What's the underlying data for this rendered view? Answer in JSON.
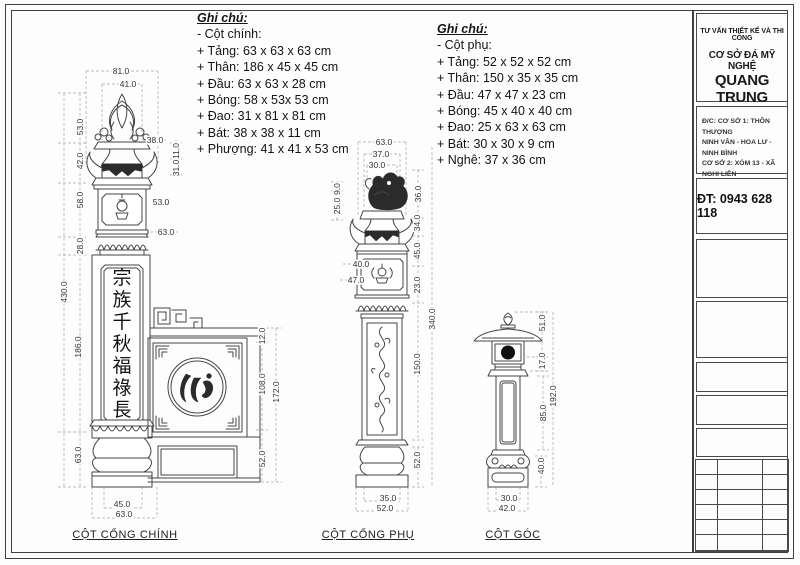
{
  "colors": {
    "line": "#454545",
    "dim_text": "#333333",
    "dashed": "#a6a6a6",
    "dark_fill": "#2b2b2b",
    "frame": "#3f3f3f"
  },
  "notes": {
    "main": {
      "title": "Ghi chú:",
      "subtitle": "- Cột chính:",
      "items": [
        "+ Tảng: 63 x 63 x 63 cm",
        "+ Thân: 186 x 45 x 45 cm",
        "+ Đầu: 63 x 63 x 28 cm",
        "+ Bóng: 58 x 53x 53 cm",
        "+ Đao: 31 x 81 x 81 cm",
        "+ Bát: 38 x 38 x 11 cm",
        "+ Phượng: 41 x 41 x 53 cm"
      ]
    },
    "secondary": {
      "title": "Ghi chú:",
      "subtitle": "- Cột phụ:",
      "items": [
        "+ Tảng: 52 x 52 x 52 cm",
        "+ Thân: 150 x 35 x 35 cm",
        "+ Đầu: 47 x 47 x 23 cm",
        "+ Bóng: 45 x 40 x 40 cm",
        "+ Đao: 25 x 63 x 63 cm",
        "+ Bát: 30 x 30 x 9 cm",
        "+ Nghê: 37 x 36  cm"
      ]
    }
  },
  "captions": {
    "main": "CỘT CỔNG CHÍNH",
    "secondary": "CỘT CỔNG PHỤ",
    "corner": "CỘT GÓC"
  },
  "inscription": {
    "characters": [
      "宗",
      "族",
      "千",
      "秋",
      "福",
      "祿",
      "長"
    ],
    "emblem_character": "心"
  },
  "title_block": {
    "line1": "TƯ VẤN THIẾT KẾ VÀ THI CÔNG",
    "line2": "CƠ SỞ ĐÁ MỸ NGHỆ",
    "company": "QUANG TRUNG",
    "address_lines": [
      "Đ/C: CƠ SỞ 1: THÔN THƯỢNG",
      "NINH VÂN - HOA LƯ - NINH BÌNH",
      "CƠ SỞ 2: XÓM 13 - XÃ NGHI LIÊN",
      "TP VINH - NGHỆ AN"
    ],
    "phone": "ĐT: 0943 628 118"
  },
  "dim_labels": [
    {
      "t": "81.0",
      "x": 121,
      "y": 71
    },
    {
      "t": "41.0",
      "x": 128,
      "y": 84
    },
    {
      "t": "53.0",
      "x": 80,
      "y": 127,
      "r": 1
    },
    {
      "t": "42.0",
      "x": 80,
      "y": 161,
      "r": 1
    },
    {
      "t": "58.0",
      "x": 80,
      "y": 200,
      "r": 1
    },
    {
      "t": "28.0",
      "x": 80,
      "y": 246,
      "r": 1
    },
    {
      "t": "430.0",
      "x": 64,
      "y": 292,
      "r": 1
    },
    {
      "t": "186.0",
      "x": 78,
      "y": 347,
      "r": 1
    },
    {
      "t": "63.0",
      "x": 78,
      "y": 455,
      "r": 1
    },
    {
      "t": "38.0",
      "x": 155,
      "y": 140
    },
    {
      "t": "11.0",
      "x": 176,
      "y": 151,
      "r": 1
    },
    {
      "t": "31.0",
      "x": 176,
      "y": 168,
      "r": 1
    },
    {
      "t": "53.0",
      "x": 161,
      "y": 202
    },
    {
      "t": "63.0",
      "x": 166,
      "y": 232
    },
    {
      "t": "45.0",
      "x": 122,
      "y": 504
    },
    {
      "t": "63.0",
      "x": 124,
      "y": 514
    },
    {
      "t": "12.0",
      "x": 262,
      "y": 336,
      "r": 1
    },
    {
      "t": "108.0",
      "x": 262,
      "y": 384,
      "r": 1
    },
    {
      "t": "172.0",
      "x": 276,
      "y": 392,
      "r": 1
    },
    {
      "t": "52.0",
      "x": 262,
      "y": 459,
      "r": 1
    },
    {
      "t": "63.0",
      "x": 384,
      "y": 142
    },
    {
      "t": "37.0",
      "x": 381,
      "y": 154
    },
    {
      "t": "30.0",
      "x": 377,
      "y": 165
    },
    {
      "t": "9.0",
      "x": 337,
      "y": 189,
      "r": 1
    },
    {
      "t": "25.0",
      "x": 337,
      "y": 206,
      "r": 1
    },
    {
      "t": "36.0",
      "x": 418,
      "y": 194,
      "r": 1
    },
    {
      "t": "34.0",
      "x": 417,
      "y": 223,
      "r": 1
    },
    {
      "t": "45.0",
      "x": 417,
      "y": 251,
      "r": 1
    },
    {
      "t": "23.0",
      "x": 417,
      "y": 285,
      "r": 1
    },
    {
      "t": "40.0",
      "x": 361,
      "y": 264
    },
    {
      "t": "47.0",
      "x": 356,
      "y": 280
    },
    {
      "t": "340.0",
      "x": 432,
      "y": 319,
      "r": 1
    },
    {
      "t": "150.0",
      "x": 417,
      "y": 364,
      "r": 1
    },
    {
      "t": "52.0",
      "x": 417,
      "y": 460,
      "r": 1
    },
    {
      "t": "35.0",
      "x": 388,
      "y": 498
    },
    {
      "t": "52.0",
      "x": 385,
      "y": 508
    },
    {
      "t": "51.0",
      "x": 542,
      "y": 323,
      "r": 1
    },
    {
      "t": "17.0",
      "x": 542,
      "y": 361,
      "r": 1
    },
    {
      "t": "192.0",
      "x": 553,
      "y": 396,
      "r": 1
    },
    {
      "t": "85.0",
      "x": 543,
      "y": 413,
      "r": 1
    },
    {
      "t": "40.0",
      "x": 541,
      "y": 466,
      "r": 1
    },
    {
      "t": "30.0",
      "x": 509,
      "y": 498
    },
    {
      "t": "42.0",
      "x": 507,
      "y": 508
    }
  ]
}
